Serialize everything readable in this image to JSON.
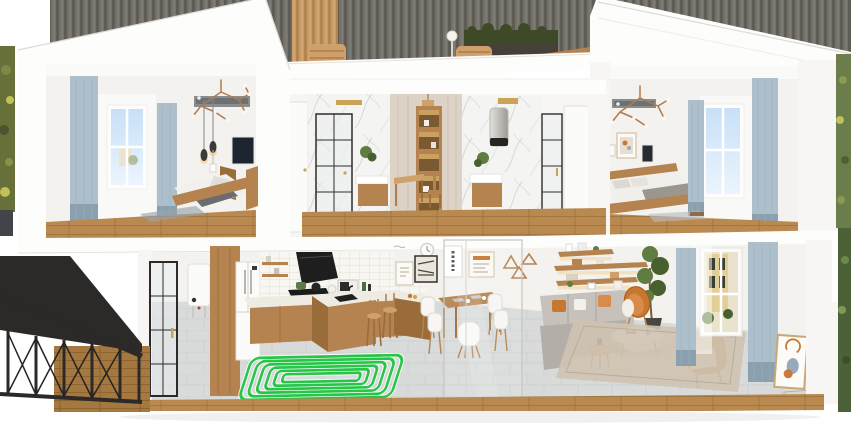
{
  "scene": {
    "type": "3d-cutaway-house-render",
    "floors": [
      {
        "name": "upper-floor",
        "rooms": [
          {
            "name": "bedroom-left",
            "objects": [
              "blue-curtains",
              "window-sky-view",
              "branch-chandelier",
              "pendant-lamps",
              "wall-tv",
              "wood-bed-gray-bedding",
              "wood-floor",
              "area-rug",
              "air-diffuser"
            ]
          },
          {
            "name": "bathroom-marble",
            "objects": [
              "white-door",
              "marble-wall",
              "black-frame-shower",
              "ceiling-light",
              "plant",
              "wood-vanity"
            ]
          },
          {
            "name": "study-nook",
            "objects": [
              "paneled-wall",
              "lit-shelf-unit",
              "wood-desk",
              "wood-chair",
              "pendant-lamp"
            ]
          },
          {
            "name": "bathroom-vanity",
            "objects": [
              "marble-wall",
              "water-heater",
              "plant",
              "wood-vanity-sink",
              "black-frame-glass-door",
              "white-door"
            ]
          },
          {
            "name": "bedroom-right",
            "objects": [
              "branch-chandelier",
              "air-diffuser",
              "framed-art",
              "wall-panel",
              "wood-bed-gray-bedding",
              "window-sky-view",
              "blue-curtains",
              "wood-floor",
              "books-on-floor"
            ]
          }
        ]
      },
      {
        "name": "ground-floor",
        "rooms": [
          {
            "name": "entry-hall",
            "objects": [
              "black-frame-glass-door",
              "wall-boiler"
            ]
          },
          {
            "name": "kitchen",
            "objects": [
              "tall-wood-cabinet",
              "white-fridge",
              "white-tile-backsplash",
              "open-shelves",
              "black-range-hood",
              "cooktop-with-pots",
              "microwave",
              "l-shaped-counter",
              "island-with-sink",
              "bar-stools",
              "underfloor-heating-coil"
            ]
          },
          {
            "name": "dining-area",
            "objects": [
              "wall-clock",
              "gallery-frames",
              "wood-triangle-decor",
              "wood-dining-table",
              "white-chairs",
              "glass-partition",
              "black-marble-base"
            ]
          },
          {
            "name": "living-room",
            "objects": [
              "floating-shelves",
              "potted-tree",
              "gray-sofa",
              "white-coffee-table",
              "round-side-table",
              "orange-shell-chair",
              "orange-armchair",
              "beige-rug",
              "window-street-view",
              "gray-curtains",
              "leaning-art-frame",
              "book-stack"
            ]
          }
        ]
      }
    ],
    "highlight": {
      "name": "underfloor-heating-coil",
      "color": "#27c548",
      "loops": 6,
      "location": "kitchen-floor"
    },
    "exterior": [
      "slatted-backdrop-wall",
      "rooftop-terrace-with-baskets",
      "hedge-planter",
      "terrace-lamp",
      "black-metal-staircase",
      "foliage-left-edge",
      "foliage-right-edge"
    ]
  },
  "palette": {
    "roof": "#fdfdfc",
    "cut": "#f7f6f4",
    "wall": "#f3f2ee",
    "ceil": "#fafaf8",
    "wood": "#b5834f",
    "woodD": "#9a6c3a",
    "woodL": "#cfa06a",
    "plank": "#b9894f",
    "plankLine": "#a2773f",
    "plankD": "#a5783f",
    "plankDLine": "#8c6531",
    "curt": "#adbfca",
    "curtD": "#8ba0ae",
    "sky1": "#8fc0ee",
    "sky2": "#d9eafc",
    "marble": "#f4f4f3",
    "vein": "#d8d7d5",
    "dark": "#262524",
    "steel1": "#e3e1dc",
    "steel2": "#9d9a94",
    "gray": "#8a8d90",
    "tileF": "#d9dbdb",
    "tileFLine": "#cbced0",
    "bs": "#f8f6f1",
    "bsLine": "#ded8ce",
    "counter": "#edebe2",
    "orange": "#c8772f",
    "orangeD": "#a85a20",
    "sofa": "#b3afa8",
    "sofaL": "#c6c2bb",
    "rug": "#cfc3b1",
    "plant": "#5f7d40",
    "plantD": "#46602e",
    "hedge": "#3e4a27",
    "coil": "#27c548",
    "slat": "#75726c",
    "slatD": "#5f5c56",
    "slatHi": "#827f78",
    "slatTan": "#c79c67",
    "slatTanD": "#b2854e",
    "slatTanHi": "#d3ab79",
    "white": "#fbfbfa",
    "glass": "#e9eef0",
    "gold": "#c9a356",
    "stair": "#2b2a28",
    "paper": "#fbfaf7",
    "copper": "#b07a4e",
    "tv": "#1c2530",
    "glow": "#f6c87c",
    "foliage1": "#667038",
    "foliage2": "#4d6138"
  }
}
